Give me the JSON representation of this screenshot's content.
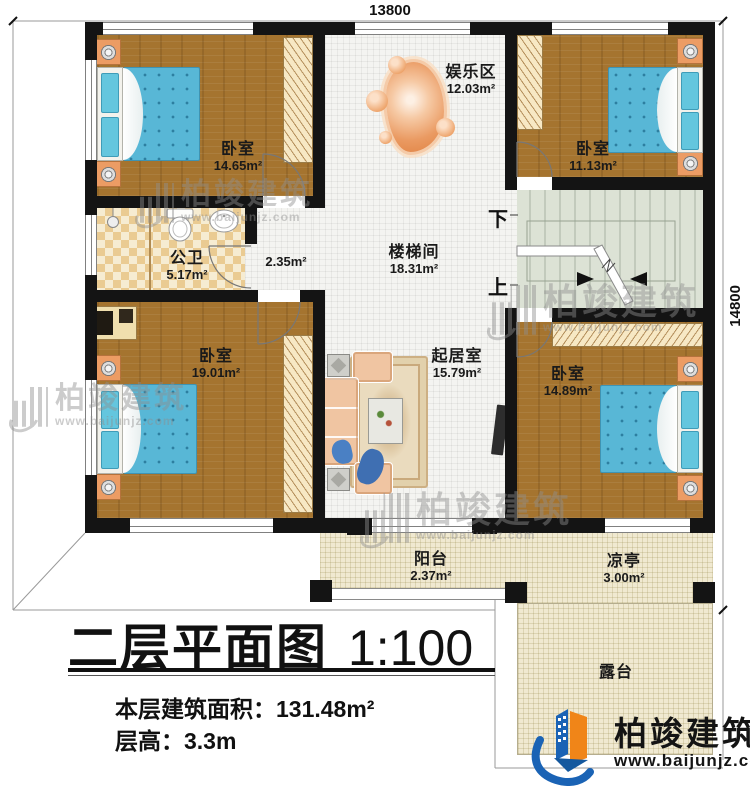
{
  "dimensions": {
    "width_label": "13800",
    "height_label": "14800"
  },
  "rooms": {
    "bedroom_tl": {
      "name": "卧室",
      "area": "14.65m²"
    },
    "bedroom_tr": {
      "name": "卧室",
      "area": "11.13m²"
    },
    "bedroom_ml": {
      "name": "卧室",
      "area": "19.01m²"
    },
    "bedroom_mr": {
      "name": "卧室",
      "area": "14.89m²"
    },
    "bathroom": {
      "name": "公卫",
      "area": "5.17m²"
    },
    "hallway": {
      "area": "2.35m²"
    },
    "entertainment": {
      "name": "娱乐区",
      "area": "12.03m²"
    },
    "stairwell": {
      "name": "楼梯间",
      "area": "18.31m²"
    },
    "living": {
      "name": "起居室",
      "area": "15.79m²"
    },
    "balcony": {
      "name": "阳台",
      "area": "2.37m²"
    },
    "pavilion": {
      "name": "凉亭",
      "area": "3.00m²"
    },
    "terrace": {
      "name": "露台"
    }
  },
  "stairs": {
    "down_label": "下",
    "up_label": "上"
  },
  "title": {
    "main": "二层平面图",
    "scale": "1:100",
    "area_line_label": "本层建筑面积：",
    "area_line_value": "131.48m²",
    "floor_height_label": "层高：",
    "floor_height_value": "3.3m"
  },
  "brand": {
    "name": "柏竣建筑",
    "website": "www.baijunjz.com"
  },
  "watermark": {
    "name": "柏竣建筑",
    "website": "www.baijunjz.com"
  },
  "colors": {
    "wall": "#141414",
    "wood_floor": "#a5742f",
    "tile_white": "#f4f4f1",
    "tile_beige": "#f0e9d1",
    "stair_green": "#dce2d5",
    "bathroom_tile": "#eacb92",
    "accent_blue": "#1a63b5",
    "accent_orange": "#f08518",
    "bed_blue": "#58b7d6",
    "furniture_peach": "#f0c5a2"
  }
}
